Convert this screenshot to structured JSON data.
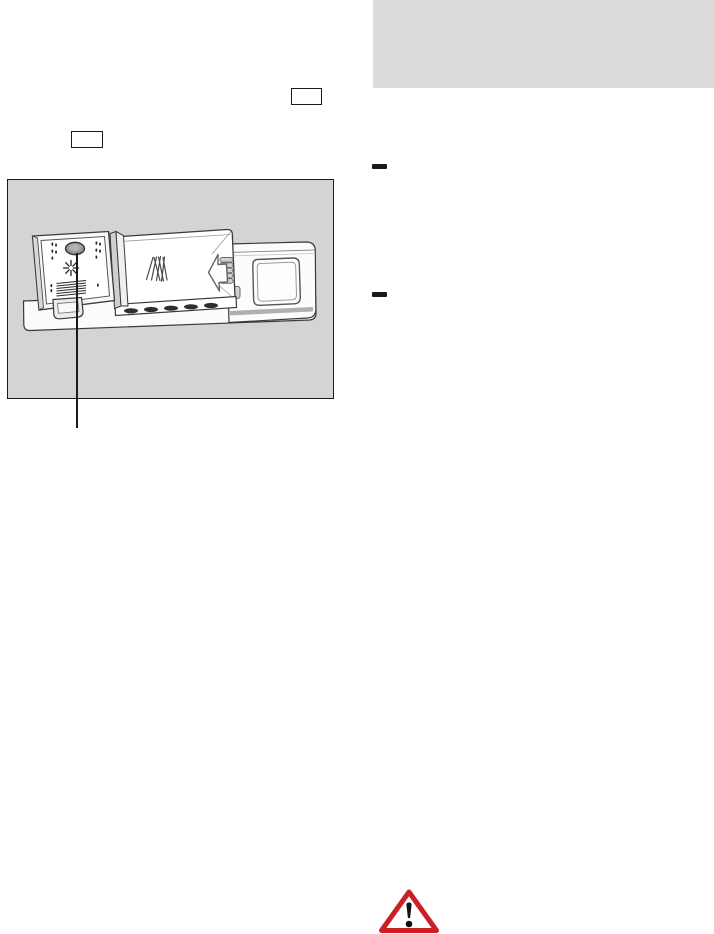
{
  "document": {
    "type": "appliance-manual-page",
    "visible_text": ""
  },
  "colors": {
    "panel-gray": "#dcdcdd",
    "figure-gray": "#d4d4d4",
    "line-black": "#1a1a1a",
    "warning-red": "#cc2027",
    "ink-black": "#111111",
    "drawing-stroke": "#3a3a3a"
  },
  "icons": {
    "warning": "warning-triangle-exclamation",
    "arrow": "arrow-left-outline",
    "sparkle": "rinse-aid-sparkle",
    "powder": "detergent-powder-sheaf"
  },
  "figure": {
    "subject": "detergent-dispenser-with-rinse-aid-cap-callout"
  }
}
